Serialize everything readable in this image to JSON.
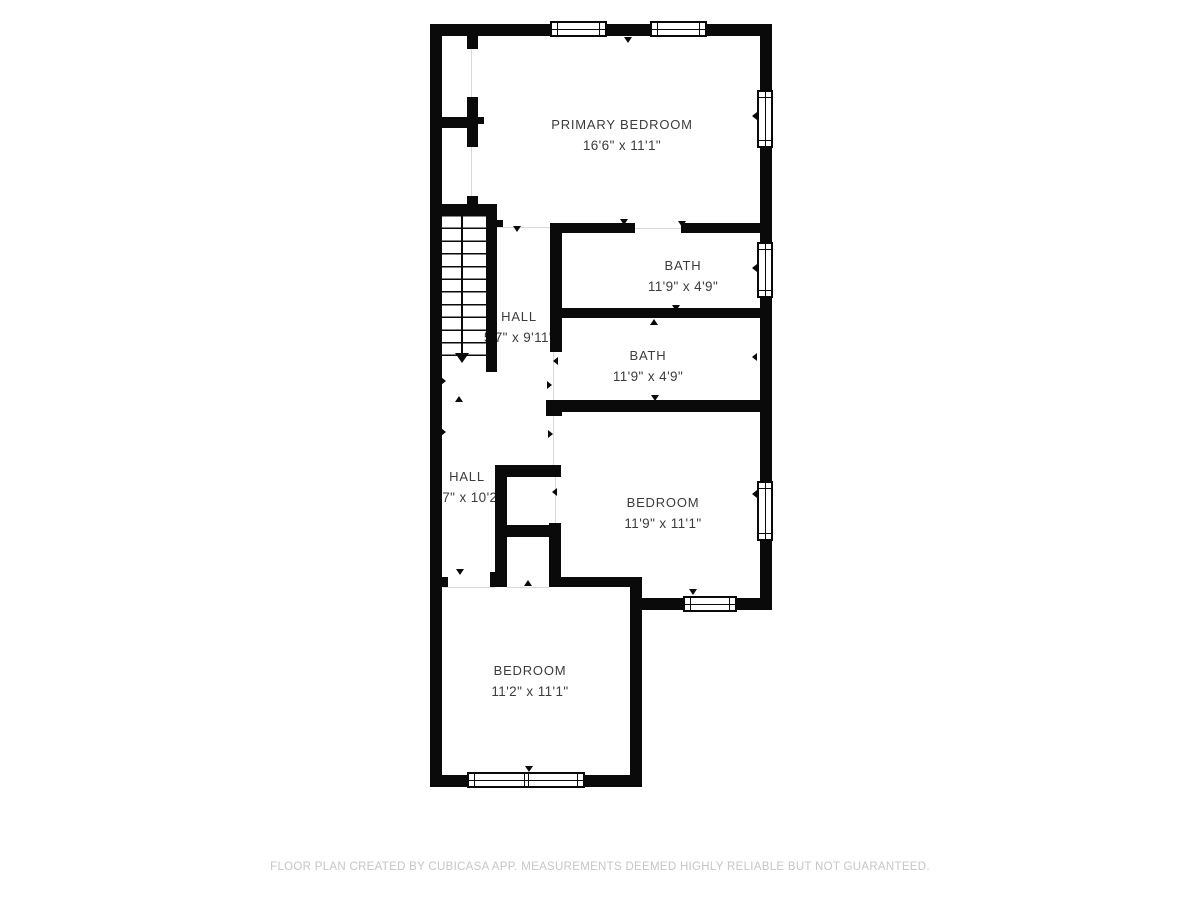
{
  "floor_plan": {
    "rooms": [
      {
        "id": "primary-bedroom",
        "name": "PRIMARY BEDROOM",
        "dims": "16'6\" x 11'1\""
      },
      {
        "id": "bath-1",
        "name": "BATH",
        "dims": "11'9\" x 4'9\""
      },
      {
        "id": "bath-2",
        "name": "BATH",
        "dims": "11'9\" x 4'9\""
      },
      {
        "id": "hall-1",
        "name": "HALL",
        "dims": "5'7\" x 9'11\""
      },
      {
        "id": "hall-2",
        "name": "HALL",
        "dims": "5'7\" x 10'2\""
      },
      {
        "id": "bedroom-right",
        "name": "BEDROOM",
        "dims": "11'9\" x 11'1\""
      },
      {
        "id": "bedroom-bottom",
        "name": "BEDROOM",
        "dims": "11'2\" x 11'1\""
      }
    ],
    "footer": "FLOOR PLAN CREATED BY CUBICASA APP. MEASUREMENTS DEEMED HIGHLY RELIABLE BUT NOT GUARANTEED.",
    "colors": {
      "wall": "#0a0a0a",
      "background": "#ffffff",
      "label": "#3c3c3c",
      "footer": "#c6c6c6"
    }
  }
}
